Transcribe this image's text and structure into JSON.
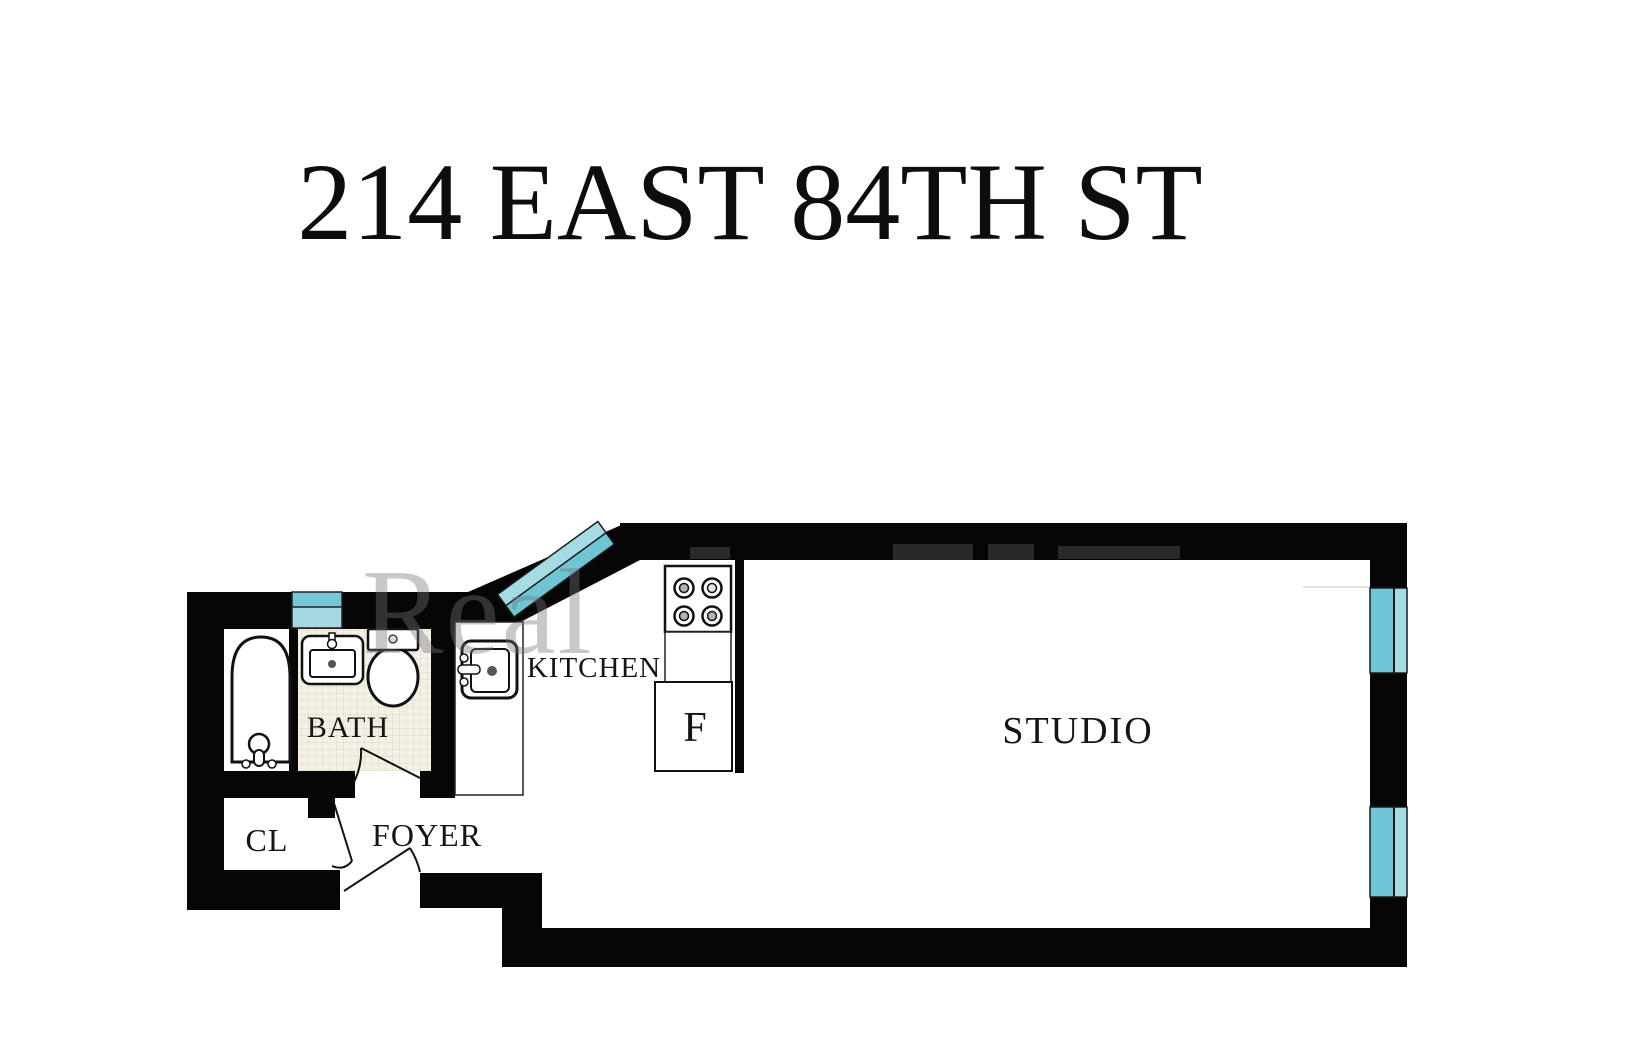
{
  "title": "214 EAST 84TH ST",
  "labels": {
    "bath": "BATH",
    "kitchen": "KITCHEN",
    "fridge": "F",
    "studio": "STUDIO",
    "foyer": "FOYER",
    "closet": "CL"
  },
  "watermark": {
    "text": "Real"
  },
  "colors": {
    "wall": "#060606",
    "window_light": "#a6dbe3",
    "window_dark": "#6fc5d4",
    "window_band_top": "#76c8d6",
    "window_band_bottom": "#a4d9e2",
    "tile_bg": "#f5f0e5",
    "tile_line": "#e0d7c3",
    "burner_inner": "#b3b3b3",
    "label_text": "#151515"
  }
}
